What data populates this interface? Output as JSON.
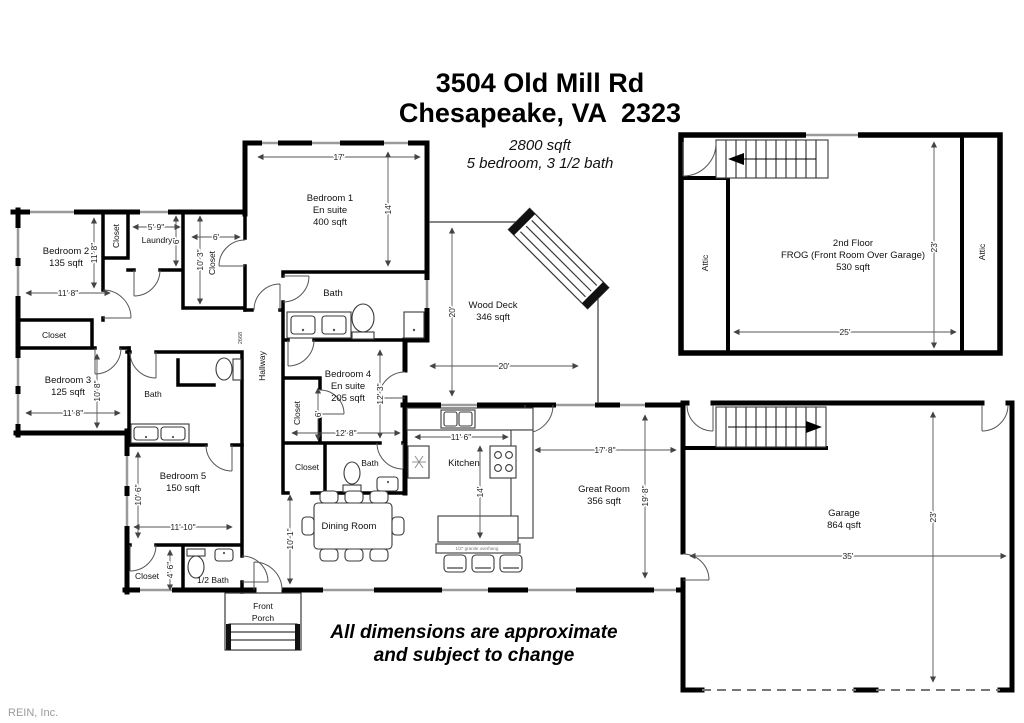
{
  "header": {
    "address_line1": "3504 Old Mill Rd",
    "address_line2": "Chesapeake, VA  2323",
    "total_area": "2800 sqft",
    "rooms_summary": "5 bedroom, 3 1/2 bath"
  },
  "rooms": {
    "bedroom1": {
      "name": "Bedroom 1",
      "suite": "En suite",
      "area": "400 sqft"
    },
    "bedroom2": {
      "name": "Bedroom 2",
      "area": "135 sqft"
    },
    "bedroom3": {
      "name": "Bedroom 3",
      "area": "125 sqft"
    },
    "bedroom4": {
      "name": "Bedroom 4",
      "suite": "En suite",
      "area": "205 sqft"
    },
    "bedroom5": {
      "name": "Bedroom 5",
      "area": "150 sqft"
    },
    "great_room": {
      "name": "Great Room",
      "area": "356 sqft"
    },
    "wood_deck": {
      "name": "Wood Deck",
      "area": "346 sqft"
    },
    "garage": {
      "name": "Garage",
      "area": "864 qsft"
    },
    "frog": {
      "line1": "2nd Floor",
      "line2": "FROG (Front Room Over Garage)",
      "line3": "530 sqft"
    },
    "kitchen": "Kitchen",
    "dining_room": "Dining Room",
    "hallway": "Hallway",
    "laundry": "Laundry",
    "bath": "Bath",
    "half_bath": "1/2 Bath",
    "closet": "Closet",
    "attic": "Attic",
    "front_porch_line1": "Front",
    "front_porch_line2": "Porch",
    "door_size_label": "2668",
    "counter_note": "1/2\" granite overhang"
  },
  "dims": {
    "d17": "17'",
    "d14": "14'",
    "d11_8": "11' 8\"",
    "d5_9": "5' 9\"",
    "d6": "6'",
    "d10_3": "10' 3\"",
    "d12_3": "12' 3\"",
    "d12_8": "12' 8\"",
    "d10_8": "10' 8\"",
    "d10_6": "10' 6\"",
    "d11_10": "11' 10\"",
    "d4_6": "4' 6\"",
    "d10_1": "10' 1\"",
    "d11_6": "11' 6\"",
    "d17_8": "17' 8\"",
    "d19_8": "19' 8\"",
    "d20": "20'",
    "d23": "23'",
    "d25": "25'",
    "d35": "35'"
  },
  "footer": {
    "disclaimer_line1": "All dimensions are approximate",
    "disclaimer_line2": "and subject to change"
  },
  "watermark": "REIN, Inc."
}
